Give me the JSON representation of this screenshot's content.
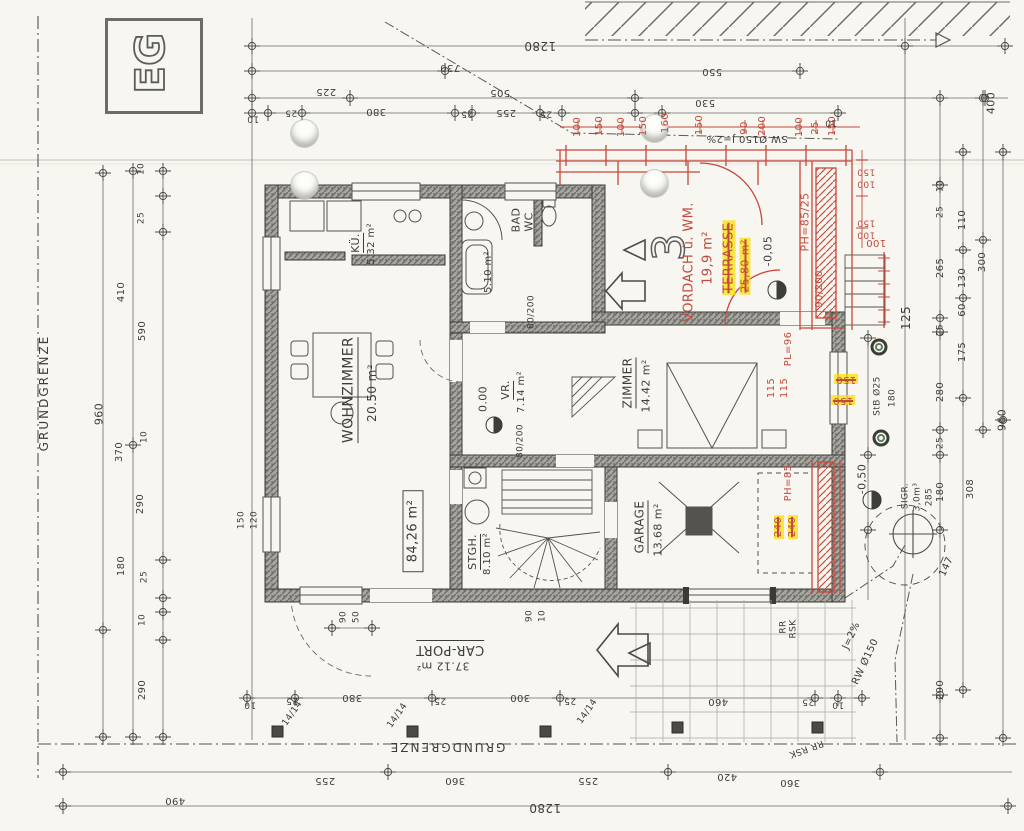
{
  "plan": {
    "floor": "EG",
    "grundgrenze_left": "GRUNDGRENZE",
    "grundgrenze_bottom": "GRUNDGRENZE",
    "total_area": "84,26 m²",
    "house_number": "3"
  },
  "rooms": {
    "wohnzimmer": {
      "name": "WOHNZIMMER",
      "area": "20.50 m²"
    },
    "kueche": {
      "name": "KÜ.",
      "area": "5.32 m²"
    },
    "bad": {
      "name": "BAD",
      "name2": "WC",
      "area": "5.10 m²"
    },
    "vr": {
      "name": "VR.",
      "area": "7.14 m²"
    },
    "zimmer": {
      "name": "ZIMMER",
      "area": "14.42 m²"
    },
    "stgh": {
      "name": "STGH.",
      "area": "8.10 m²"
    },
    "garage": {
      "name": "GARAGE",
      "area": "13.68 m²"
    },
    "carport": {
      "name": "CAR-PORT",
      "area": "37.12 m²"
    }
  },
  "levels": {
    "eg": "0.00",
    "terrasse": "-0,05",
    "garten": "-0,50"
  },
  "red": {
    "vordach": "VORDACH ü. WM.",
    "vordach_area": "19,9 m²",
    "terrasse": "TERRASSE",
    "terrasse_area": "25,80 m²",
    "ph8525": "PH=85/25",
    "pl96": "PL=96",
    "ph85": "PH=85",
    "v115a": "115",
    "v115b": "115",
    "n240a": "240",
    "n240b": "240",
    "door": "90/200",
    "d100": "100",
    "hl150a": "150",
    "hl150b": "150",
    "win": [
      "150",
      "100",
      "150",
      "100"
    ],
    "row": [
      "100",
      "150",
      "100",
      "150",
      "160",
      "150",
      "90",
      "200",
      "100",
      "25",
      "150"
    ]
  },
  "utils": {
    "sw": "SW Ø150 J=2%",
    "rw": "RW Ø150",
    "rwj": "J=2%",
    "rr1a": "RR",
    "rr1b": "RSK",
    "rr2": "RR RSK",
    "sigr": "SIGR.",
    "sigr_vol": "3,0m³",
    "sigr_dim": "285",
    "stb": "StB Ø25",
    "stb_dim": "180"
  },
  "doors": {
    "d1": "80/200",
    "d2": "80/200",
    "w1a": "150",
    "w1b": "120",
    "post": "14/14"
  },
  "dims": {
    "top": [
      "1280",
      "730",
      "225",
      "505",
      "550",
      "530",
      "10",
      "25",
      "380",
      "25",
      "255",
      "25",
      "10"
    ],
    "left": [
      "10",
      "25",
      "410",
      "590",
      "960",
      "370",
      "10",
      "290",
      "180",
      "25",
      "10",
      "290"
    ],
    "right": [
      "400",
      "10",
      "25",
      "110",
      "265",
      "130",
      "300",
      "60",
      "25",
      "175",
      "280",
      "960",
      "25",
      "180",
      "147",
      "308",
      "290",
      "125"
    ],
    "bottom": [
      "10",
      "25",
      "380",
      "25",
      "300",
      "25",
      "460",
      "25",
      "10",
      "255",
      "360",
      "255",
      "420",
      "360",
      "1280",
      "490",
      "90",
      "50",
      "90",
      "10"
    ]
  }
}
